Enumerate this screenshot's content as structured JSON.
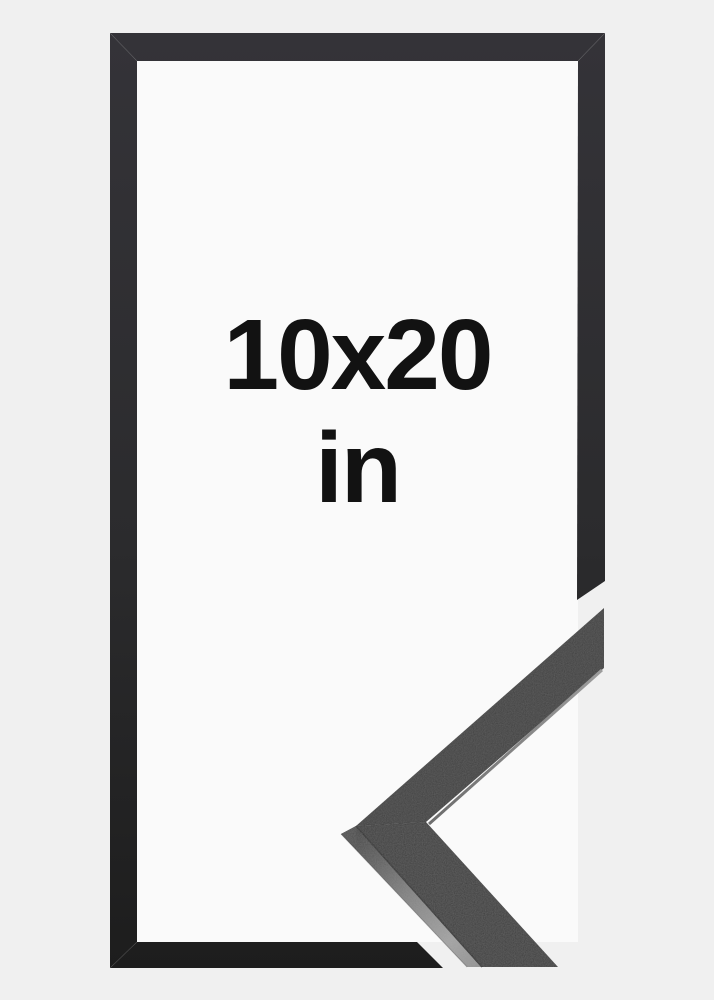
{
  "label": {
    "size": "10x20",
    "unit": "in",
    "text_color": "#121212"
  },
  "colors": {
    "background": "#f0f0f0",
    "frame_interior": "#fafafa",
    "frame_border_top": "#343338",
    "frame_border_bottom": "#1d1d1d",
    "moulding_top_face": "#333333",
    "moulding_side_highlight": "#9e9e9e",
    "moulding_edge_dark": "#1c1c1c"
  }
}
